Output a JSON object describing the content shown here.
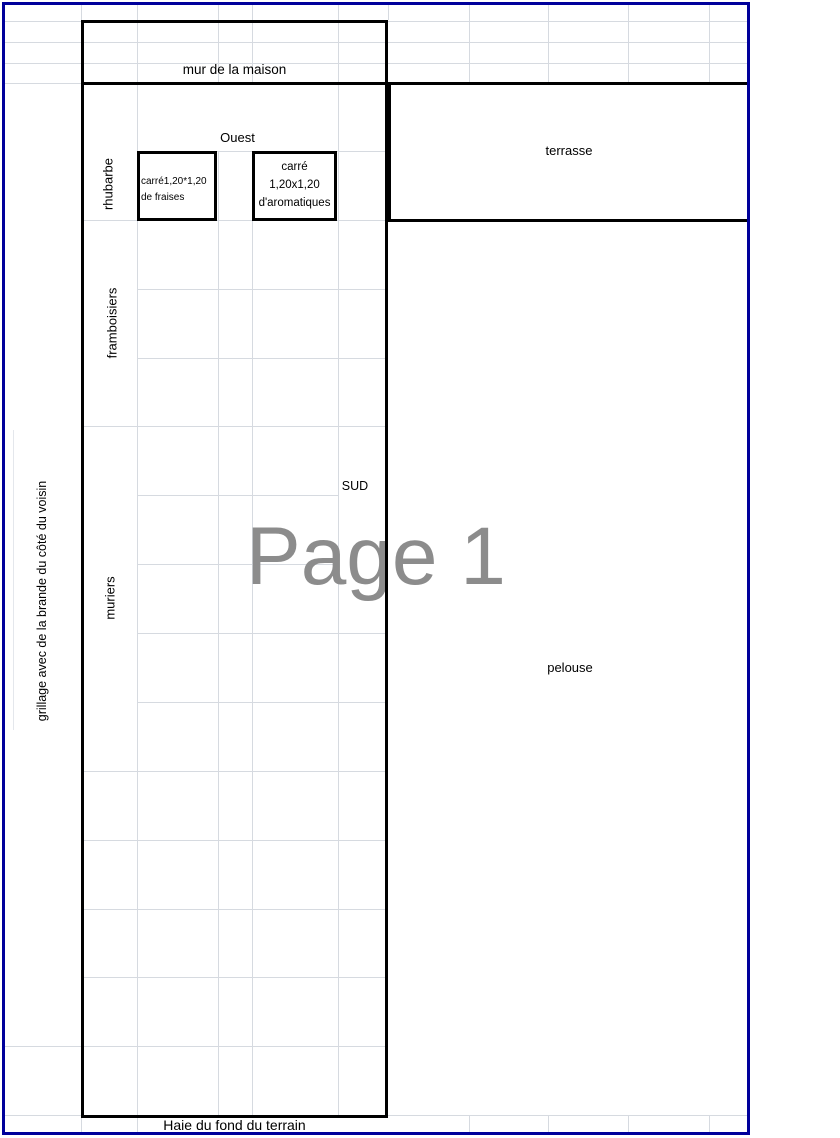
{
  "app": {
    "view": "page-break-preview",
    "watermark": "Page 1"
  },
  "garden_plan": {
    "wall_label": "mur de la maison",
    "west_label": "Ouest",
    "terrace_label": "terrasse",
    "rhubarb_label": "rhubarbe",
    "strawberry_square": {
      "line1": "carré1,20*1,20",
      "line2": "de fraises"
    },
    "aromatic_square": {
      "line1": "carré",
      "line2": "1,20x1,20",
      "line3": "d'aromatiques"
    },
    "raspberry_label": "framboisiers",
    "south_label": "SUD",
    "mulberry_label": "muriers",
    "lawn_label": "pelouse",
    "neighbor_fence_label": "grillage avec de la brande du côté du voisin",
    "hedge_label": "Haie du fond du terrain"
  },
  "colors": {
    "page_border": "#00009B",
    "gridline": "#D6DAE0",
    "shape_border": "#000000",
    "watermark": "#8C8C8C"
  }
}
